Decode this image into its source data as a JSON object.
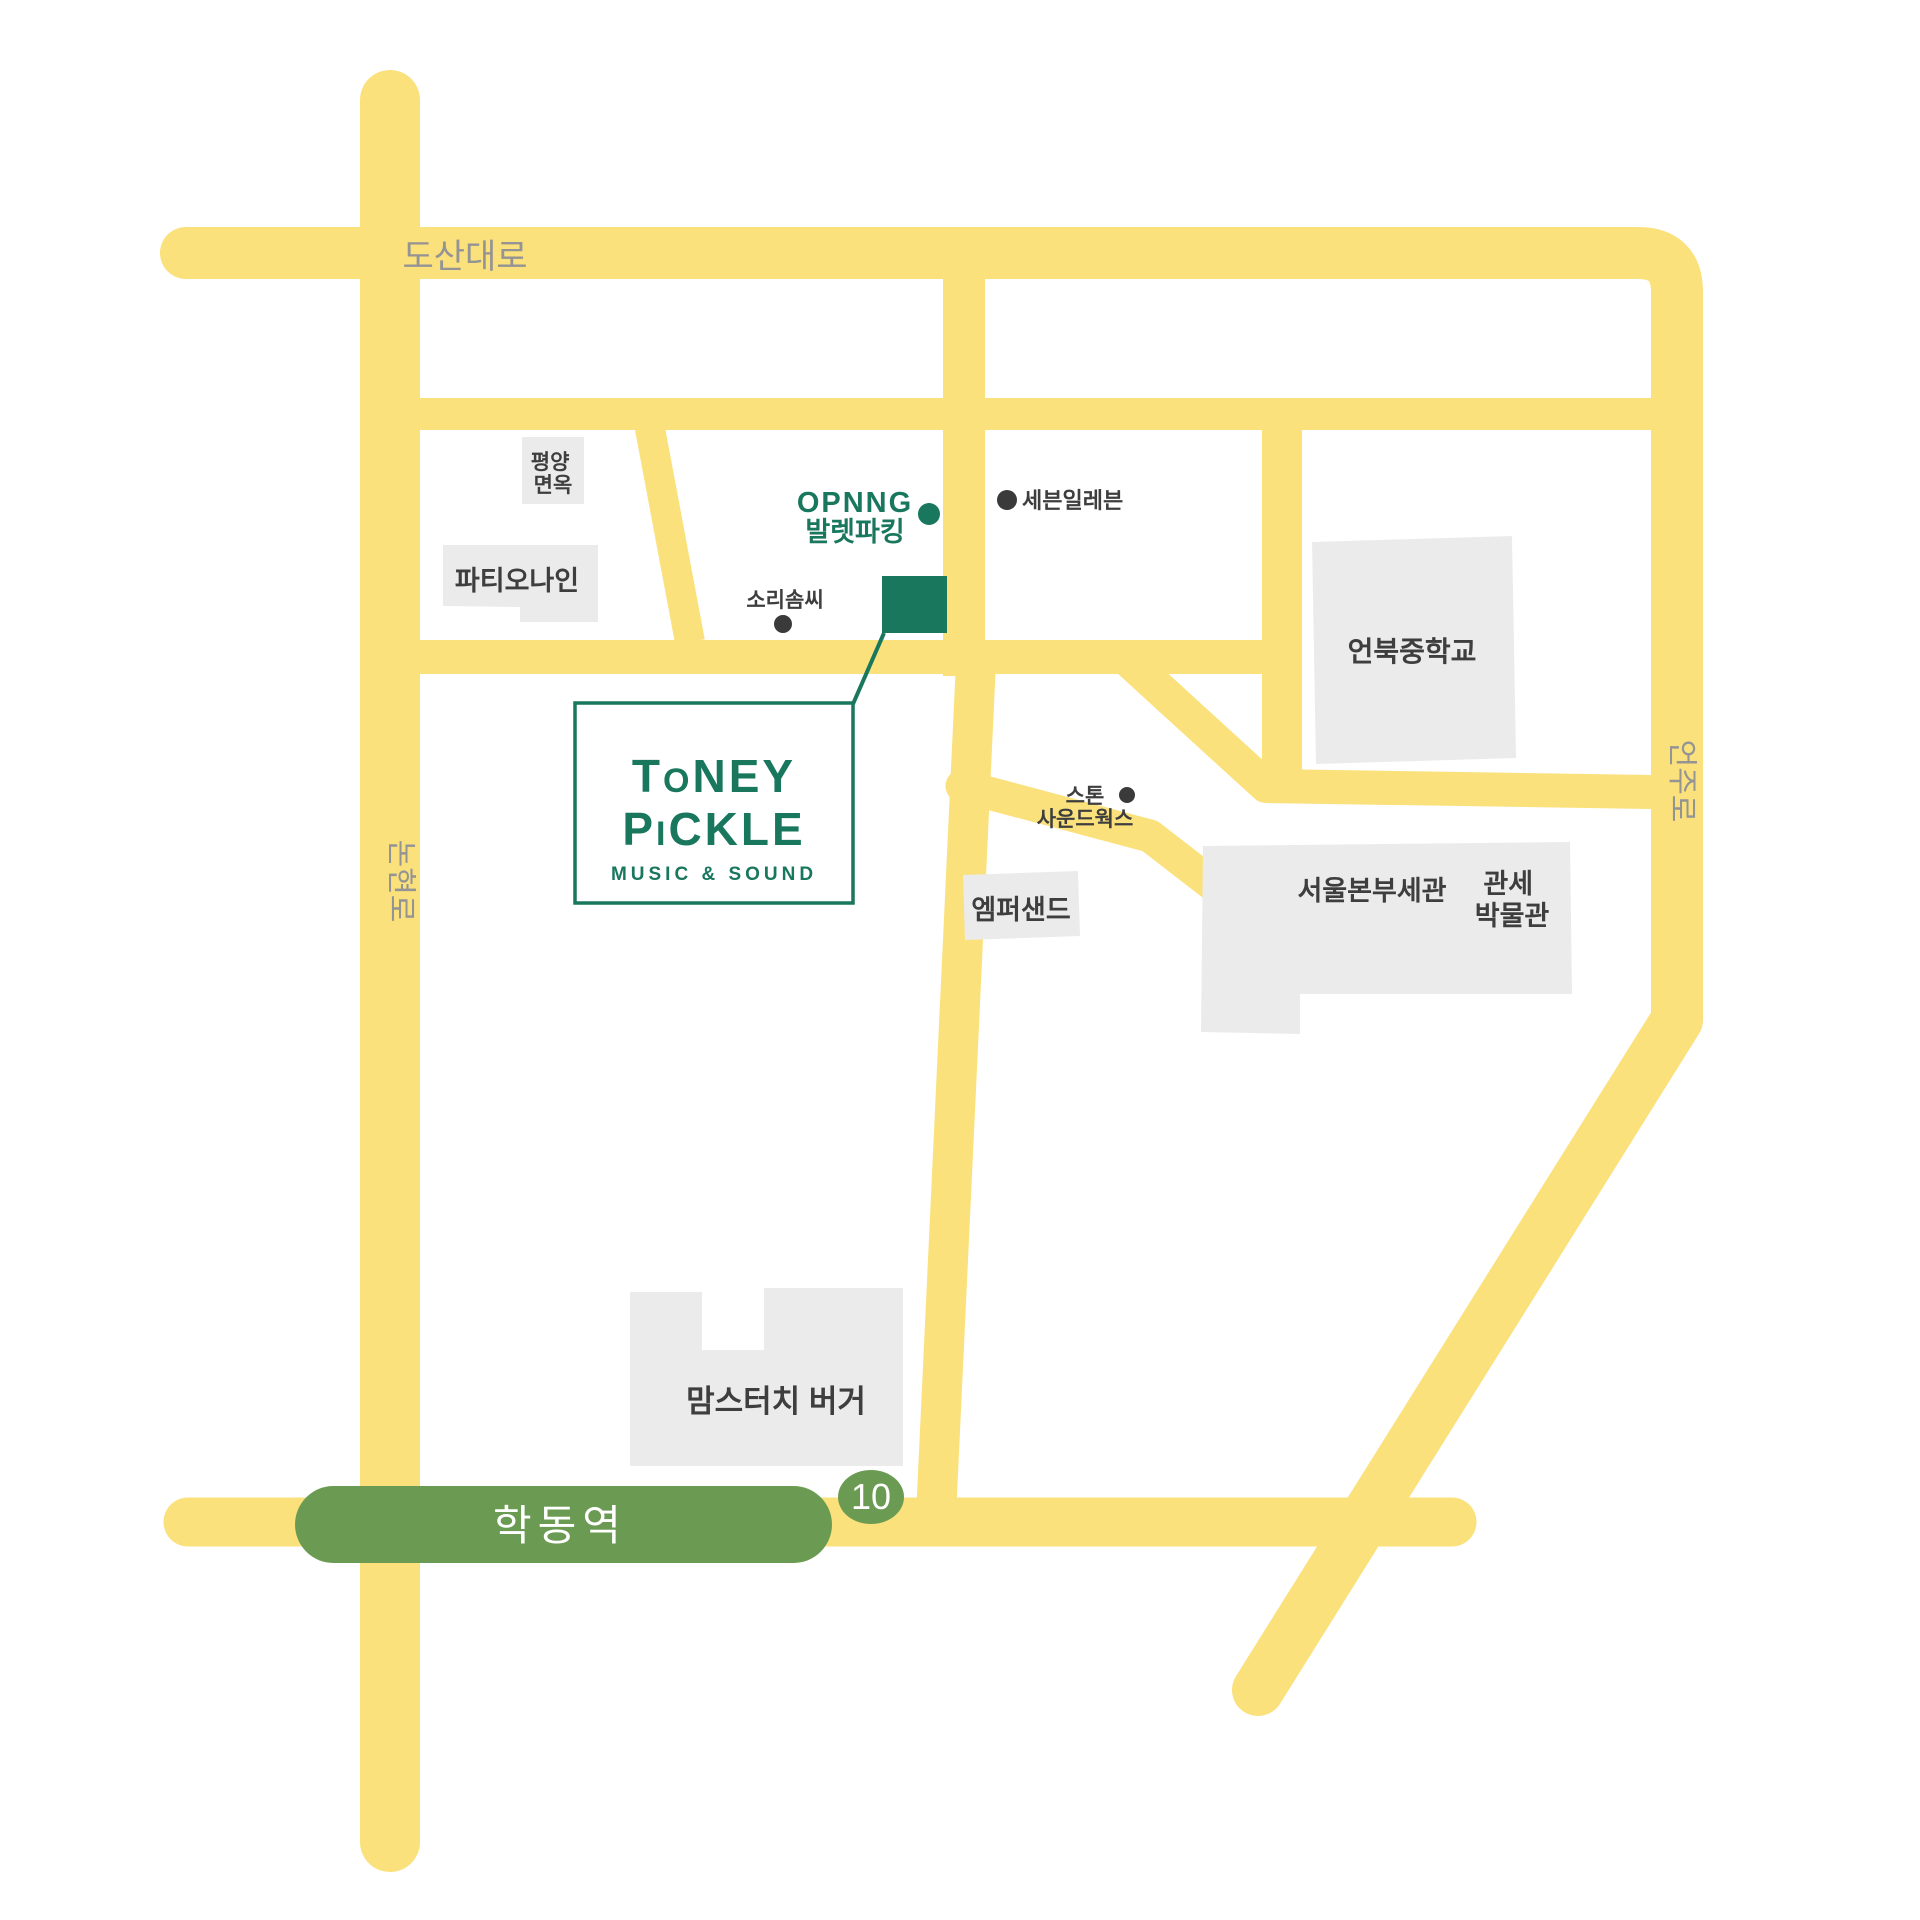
{
  "colors": {
    "road_yellow": "#FAE17C",
    "brand_green": "#18775D",
    "station_green": "#6B9B52",
    "building_gray": "#EBEBEB",
    "label_dark": "#3E3E3E",
    "road_label_gray": "#949494",
    "background": "#FFFFFF"
  },
  "road_labels": {
    "dosandaero": "도산대로",
    "nonhyeonro": "논현로",
    "eonjuro": "언주로"
  },
  "station": {
    "name": "학동역",
    "exit_number": "10"
  },
  "logo": {
    "line1_big_left": "T",
    "line1_small": "O",
    "line1_big_right": "NEY",
    "line2_big_left": "P",
    "line2_small": "I",
    "line2_big_right": "CKLE",
    "subtitle": "MUSIC & SOUND"
  },
  "valet": {
    "line1": "OPNNG",
    "line2": "발렛파킹"
  },
  "places": {
    "pyeongyang_line1": "평양",
    "pyeongyang_line2": "면옥",
    "patio_nine": "파티오나인",
    "sorisomssi": "소리솜씨",
    "seven_eleven": "세븐일레븐",
    "eonbuk_middle_school": "언북중학교",
    "stone_line1": "스톤",
    "stone_line2": "사운드웍스",
    "ampersand": "엠퍼샌드",
    "seoul_customs": "서울본부세관",
    "customs_museum_line1": "관세",
    "customs_museum_line2": "박물관",
    "momstouch_burger": "맘스터치 버거"
  }
}
